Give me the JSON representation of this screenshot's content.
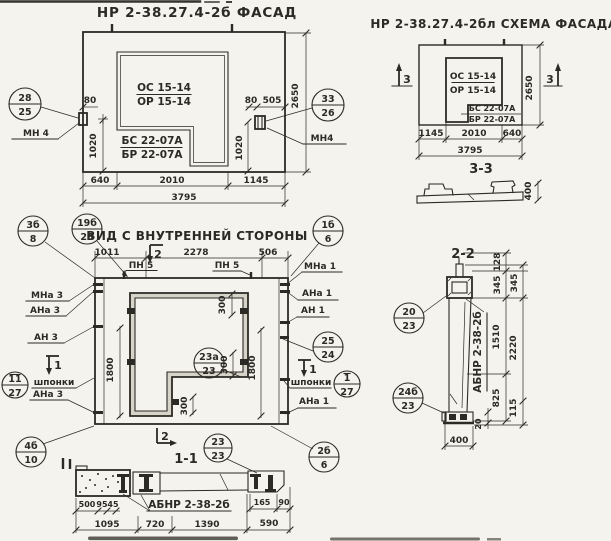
{
  "drawing": {
    "paper_color": "#f4f3ee",
    "ink_color": "#2b2a25"
  },
  "facade": {
    "title": "НР 2-38.27.4-2б  ФАСАД",
    "opening_mark_line1": "ОС 15-14",
    "opening_mark_line2": "ОР 15-14",
    "sill_mark_line1": "БС 22-07А",
    "sill_mark_line2": "БР 22-07А",
    "anchor_label_left": "МН 4",
    "anchor_label_right": "МН4",
    "callout_left_num": "28",
    "callout_left_sheet": "25",
    "callout_right_num": "33",
    "callout_right_sheet": "26",
    "dim_80_left": "80",
    "dim_1020_left": "1020",
    "dim_80_right": "80",
    "dim_505": "505",
    "dim_1020_right": "1020",
    "dim_2650": "2650",
    "dim_640": "640",
    "dim_2010": "2010",
    "dim_1145": "1145",
    "dim_3795": "3795"
  },
  "schema": {
    "title": "НР 2-38.27.4-2бл СХЕМА ФАСАДА",
    "opening_mark_line1": "ОС 15-14",
    "opening_mark_line2": "ОР 15-14",
    "sill_mark_line1": "БС 22-07А",
    "sill_mark_line2": "БР 22-07А",
    "cut3_left": "3",
    "cut3_right": "3",
    "dim_2650": "2650",
    "dim_1145": "1145",
    "dim_2010": "2010",
    "dim_640": "640",
    "dim_3795": "3795"
  },
  "section33": {
    "title": "3-3",
    "dim_400": "400"
  },
  "inner": {
    "title": "ВИД С ВНУТРЕННЕЙ СТОРОНЫ",
    "dim_1011": "1011",
    "dim_2278": "2278",
    "dim_506": "506",
    "dim_300_top": "300",
    "dim_300_mid": "300",
    "dim_300_bot": "300",
    "dim_1800_left": "1800",
    "dim_1800_right": "1800",
    "label_pn5_left": "ПН 5",
    "label_pn5_right": "ПН 5",
    "label_mna3": "МНа 3",
    "label_ana3": "АНа 3",
    "label_an3": "АН 3",
    "label_shponki_left": "шпонки",
    "label_ana3_low": "АНа 3",
    "label_mna1": "МНа 1",
    "label_ana1": "АНа 1",
    "label_an1": "АН 1",
    "label_shponki_right": "шпонки",
    "label_ana1_low": "АНа 1",
    "cut2_top": "2",
    "cut2_bottom": "2",
    "cut1_left": "1",
    "cut1_right": "1",
    "callout_3b_num": "3б",
    "callout_3b_sheet": "8",
    "callout_19b_num": "19б",
    "callout_19b_sheet": "28",
    "callout_1b_num": "1б",
    "callout_1b_sheet": "6",
    "callout_25_num": "25",
    "callout_25_sheet": "24",
    "callout_11_num": "11",
    "callout_11_sheet": "27",
    "callout_1_num": "1",
    "callout_1_sheet": "27",
    "callout_23a_num": "23а",
    "callout_23a_sheet": "23",
    "callout_23_num": "23",
    "callout_23_sheet": "23",
    "callout_4b_num": "4б",
    "callout_4b_sheet": "10",
    "callout_2b_num": "2б",
    "callout_2b_sheet": "6"
  },
  "section11": {
    "title": "1-1",
    "label_abnr": "АБНР 2-38-2б",
    "dim_500": "500",
    "dim_95": "95",
    "dim_45": "45",
    "dim_165": "165",
    "dim_90": "90",
    "dim_1095": "1095",
    "dim_720": "720",
    "dim_1390": "1390",
    "dim_590": "590"
  },
  "section22": {
    "title": "2-2",
    "label_abnr": "АБНР 2-38-2б",
    "callout_20_num": "20",
    "callout_20_sheet": "23",
    "callout_24b_num": "24б",
    "callout_24b_sheet": "23",
    "dim_128": "128",
    "dim_345_inner": "345",
    "dim_345_outer": "345",
    "dim_1510": "1510",
    "dim_2220": "2220",
    "dim_825": "825",
    "dim_115": "115",
    "dim_20": "20",
    "dim_400": "400"
  }
}
